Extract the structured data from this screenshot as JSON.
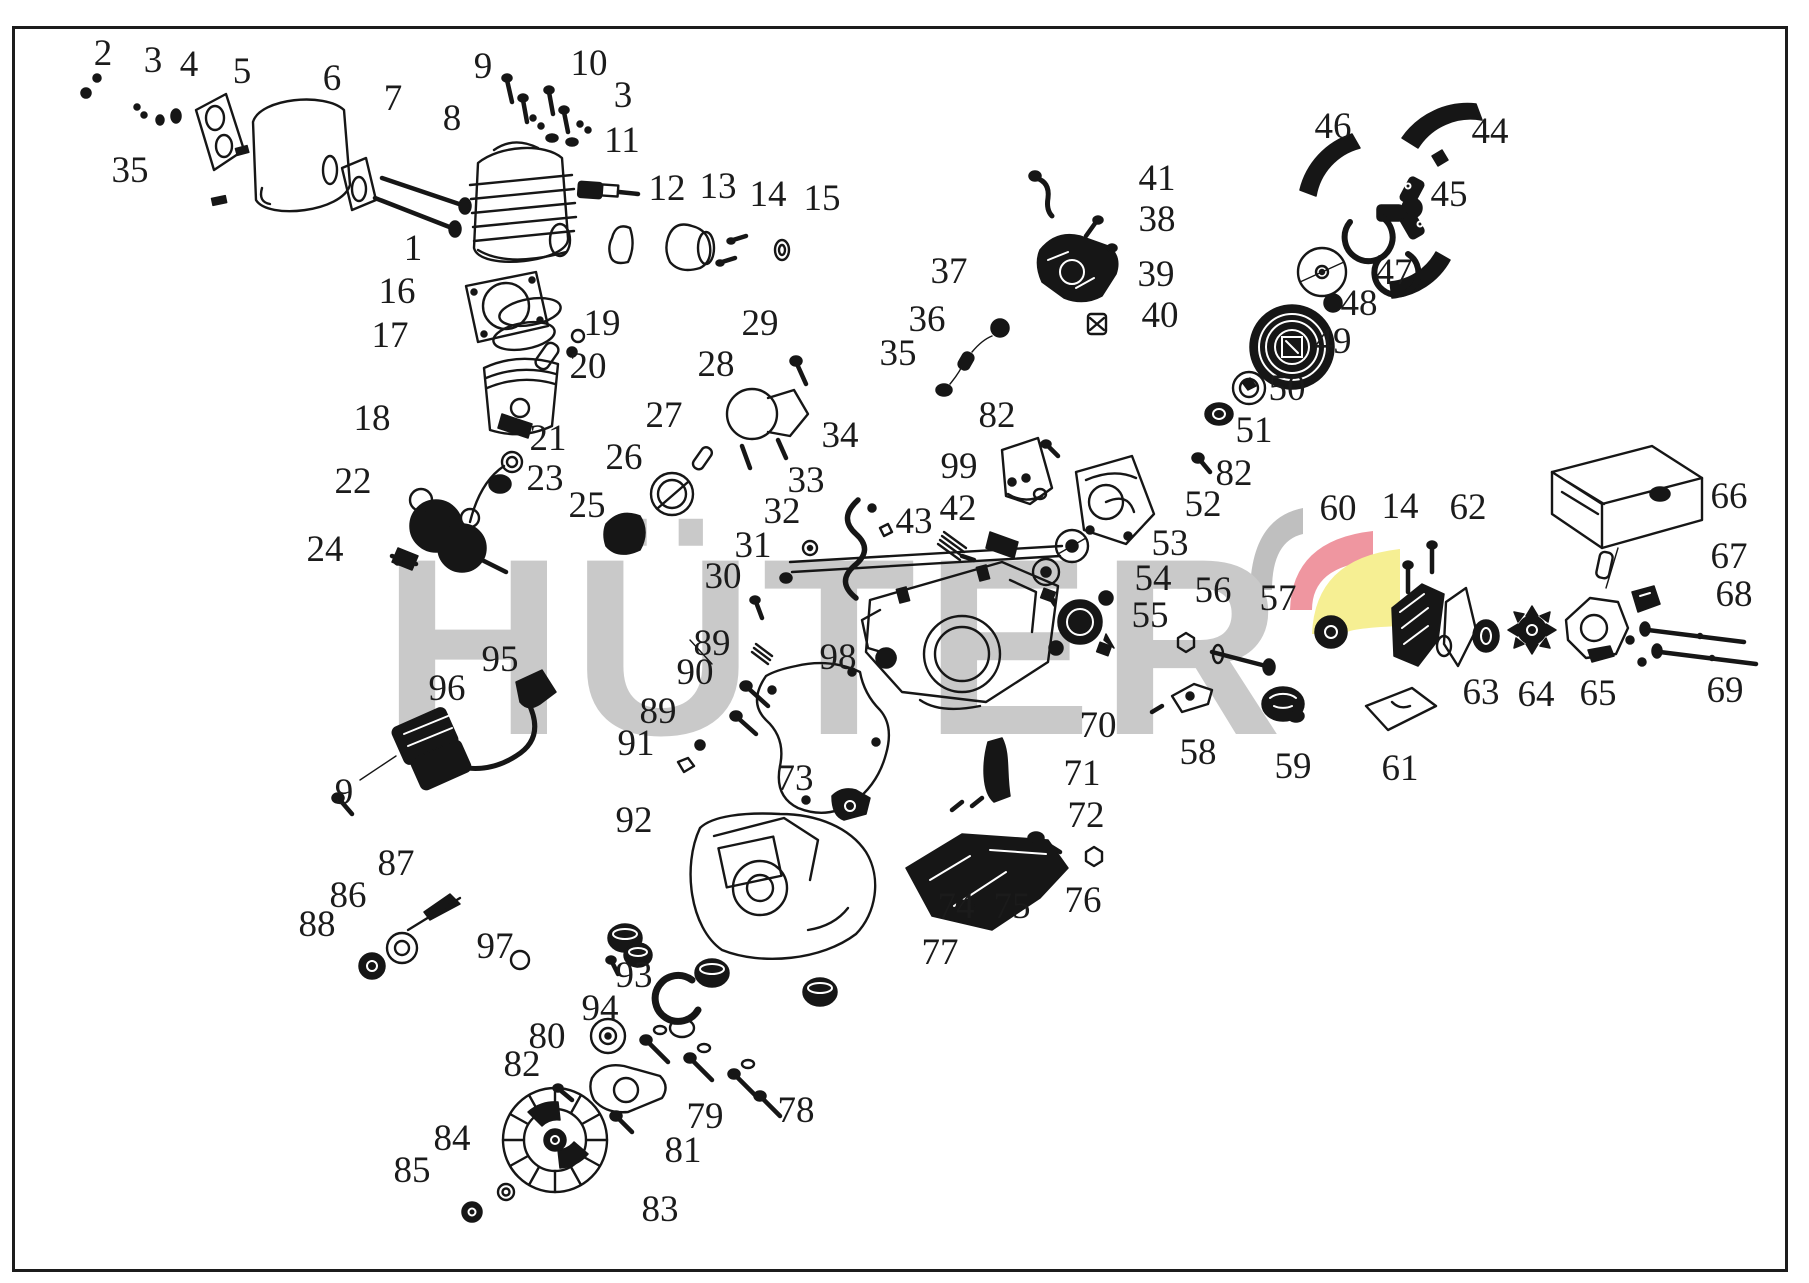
{
  "figure": {
    "width": 1809,
    "height": 1283,
    "border_color": "#1c1c1c",
    "background": "#ffffff"
  },
  "watermark": {
    "text": "HÜTER",
    "text_color": "#c9c9c9",
    "logo_colors": {
      "gray": "#bfbfbf",
      "red": "#ef96a0",
      "yellow": "#f6ef93"
    }
  },
  "diagram": {
    "type": "exploded-parts-diagram",
    "subject": "chainsaw engine and assembly",
    "label_color": "#1b1b1b",
    "line_color": "#1c1c1c"
  },
  "axis_lines": [
    [
      432,
      545,
      1425,
      693
    ],
    [
      408,
      558,
      1190,
      756
    ],
    [
      424,
      566,
      558,
      1120
    ]
  ],
  "labels": [
    {
      "id": "c1",
      "n": "1",
      "x": 413,
      "y": 250,
      "tx": 492,
      "ty": 272
    },
    {
      "id": "c2",
      "n": "2",
      "x": 103,
      "y": 55,
      "tx": 95,
      "ty": 88
    },
    {
      "id": "c3a",
      "n": "3",
      "x": 153,
      "y": 62,
      "tx": 142,
      "ty": 102
    },
    {
      "id": "c3b",
      "n": "3",
      "x": 623,
      "y": 97,
      "tx": 580,
      "ty": 122
    },
    {
      "id": "c4",
      "n": "4",
      "x": 189,
      "y": 66,
      "tx": 176,
      "ty": 112
    },
    {
      "id": "c5",
      "n": "5",
      "x": 242,
      "y": 73,
      "tx": 212,
      "ty": 125
    },
    {
      "id": "c6",
      "n": "6",
      "x": 332,
      "y": 80,
      "tx": 300,
      "ty": 108
    },
    {
      "id": "c7",
      "n": "7",
      "x": 393,
      "y": 100,
      "tx": 358,
      "ty": 162
    },
    {
      "id": "c8",
      "n": "8",
      "x": 452,
      "y": 120,
      "tx": 420,
      "ty": 180
    },
    {
      "id": "c9a",
      "n": "9",
      "x": 483,
      "y": 68,
      "tx": 512,
      "ty": 88
    },
    {
      "id": "c9b",
      "n": "9",
      "x": 344,
      "y": 794,
      "tx": 340,
      "ty": 806
    },
    {
      "id": "c10",
      "n": "10",
      "x": 589,
      "y": 65,
      "tx": 530,
      "ty": 110
    },
    {
      "id": "c11",
      "n": "11",
      "x": 622,
      "y": 142,
      "tx": 600,
      "ty": 182
    },
    {
      "id": "c12",
      "n": "12",
      "x": 667,
      "y": 190,
      "tx": 630,
      "ty": 232
    },
    {
      "id": "c13",
      "n": "13",
      "x": 718,
      "y": 188,
      "tx": 695,
      "ty": 225
    },
    {
      "id": "c14a",
      "n": "14",
      "x": 768,
      "y": 196,
      "tx": 740,
      "ty": 235
    },
    {
      "id": "c14b",
      "n": "14",
      "x": 1400,
      "y": 508,
      "tx": 1408,
      "ty": 566
    },
    {
      "id": "c15",
      "n": "15",
      "x": 822,
      "y": 200,
      "tx": 786,
      "ty": 242
    },
    {
      "id": "c16",
      "n": "16",
      "x": 397,
      "y": 293,
      "tx": 466,
      "ty": 300
    },
    {
      "id": "c17",
      "n": "17",
      "x": 390,
      "y": 337,
      "tx": 500,
      "ty": 318
    },
    {
      "id": "c18",
      "n": "18",
      "x": 372,
      "y": 420,
      "tx": 470,
      "ty": 428
    },
    {
      "id": "c19",
      "n": "19",
      "x": 602,
      "y": 325,
      "tx": 578,
      "ty": 336
    },
    {
      "id": "c20",
      "n": "20",
      "x": 588,
      "y": 368,
      "tx": 556,
      "ty": 360
    },
    {
      "id": "c21",
      "n": "21",
      "x": 548,
      "y": 440,
      "tx": 518,
      "ty": 460
    },
    {
      "id": "c22",
      "n": "22",
      "x": 353,
      "y": 483,
      "tx": 430,
      "ty": 505
    },
    {
      "id": "c23",
      "n": "23",
      "x": 545,
      "y": 480,
      "tx": 508,
      "ty": 482
    },
    {
      "id": "c24",
      "n": "24",
      "x": 325,
      "y": 551,
      "tx": 396,
      "ty": 559
    },
    {
      "id": "c25",
      "n": "25",
      "x": 587,
      "y": 507,
      "tx": 618,
      "ty": 532
    },
    {
      "id": "c26",
      "n": "26",
      "x": 624,
      "y": 459,
      "tx": 655,
      "ty": 488
    },
    {
      "id": "c27",
      "n": "27",
      "x": 664,
      "y": 417,
      "tx": 700,
      "ty": 450
    },
    {
      "id": "c28",
      "n": "28",
      "x": 716,
      "y": 366,
      "tx": 740,
      "ty": 400
    },
    {
      "id": "c29",
      "n": "29",
      "x": 760,
      "y": 325,
      "tx": 797,
      "ty": 362
    },
    {
      "id": "c30",
      "n": "30",
      "x": 723,
      "y": 578,
      "tx": 756,
      "ty": 600
    },
    {
      "id": "c31",
      "n": "31",
      "x": 753,
      "y": 547,
      "tx": 782,
      "ty": 575
    },
    {
      "id": "c32",
      "n": "32",
      "x": 782,
      "y": 513,
      "tx": 808,
      "ty": 545
    },
    {
      "id": "c33",
      "n": "33",
      "x": 806,
      "y": 482,
      "tx": 852,
      "ty": 520
    },
    {
      "id": "c34",
      "n": "34",
      "x": 840,
      "y": 437,
      "tx": 872,
      "ty": 505
    },
    {
      "id": "c35a",
      "n": "35",
      "x": 130,
      "y": 172,
      "tx": 212,
      "ty": 200
    },
    {
      "id": "c35b",
      "n": "35",
      "x": 898,
      "y": 355,
      "tx": 940,
      "ty": 388
    },
    {
      "id": "c36",
      "n": "36",
      "x": 927,
      "y": 321,
      "tx": 962,
      "ty": 358
    },
    {
      "id": "c37",
      "n": "37",
      "x": 949,
      "y": 273,
      "tx": 1000,
      "ty": 322
    },
    {
      "id": "c38",
      "n": "38",
      "x": 1157,
      "y": 221,
      "tx": 1086,
      "ty": 242
    },
    {
      "id": "c39",
      "n": "39",
      "x": 1156,
      "y": 276,
      "tx": 1092,
      "ty": 280
    },
    {
      "id": "c40",
      "n": "40",
      "x": 1160,
      "y": 317,
      "tx": 1100,
      "ty": 322
    },
    {
      "id": "c41",
      "n": "41",
      "x": 1157,
      "y": 180,
      "tx": 1048,
      "ty": 184
    },
    {
      "id": "c42",
      "n": "42",
      "x": 958,
      "y": 510,
      "tx": 1000,
      "ty": 537
    },
    {
      "id": "c43",
      "n": "43",
      "x": 914,
      "y": 523,
      "tx": 945,
      "ty": 550
    },
    {
      "id": "c44",
      "n": "44",
      "x": 1490,
      "y": 133,
      "tx": 1440,
      "ty": 133
    },
    {
      "id": "c45",
      "n": "45",
      "x": 1449,
      "y": 196,
      "tx": 1405,
      "ty": 203
    },
    {
      "id": "c46",
      "n": "46",
      "x": 1333,
      "y": 128,
      "tx": 1340,
      "ty": 212
    },
    {
      "id": "c47",
      "n": "47",
      "x": 1394,
      "y": 274,
      "tx": 1344,
      "ty": 273
    },
    {
      "id": "c48",
      "n": "48",
      "x": 1359,
      "y": 305,
      "tx": 1339,
      "ty": 303
    },
    {
      "id": "c49",
      "n": "49",
      "x": 1333,
      "y": 343,
      "tx": 1292,
      "ty": 347
    },
    {
      "id": "c50",
      "n": "50",
      "x": 1287,
      "y": 390,
      "tx": 1247,
      "ty": 387
    },
    {
      "id": "c51",
      "n": "51",
      "x": 1254,
      "y": 432,
      "tx": 1217,
      "ty": 415
    },
    {
      "id": "c52",
      "n": "52",
      "x": 1203,
      "y": 506,
      "tx": 1137,
      "ty": 505
    },
    {
      "id": "c53",
      "n": "53",
      "x": 1170,
      "y": 545,
      "tx": 1088,
      "ty": 546
    },
    {
      "id": "c54",
      "n": "54",
      "x": 1153,
      "y": 580,
      "tx": 1061,
      "ty": 571
    },
    {
      "id": "c55",
      "n": "55",
      "x": 1150,
      "y": 617,
      "tx": 1097,
      "ty": 622
    },
    {
      "id": "c56",
      "n": "56",
      "x": 1213,
      "y": 592,
      "tx": 1185,
      "ty": 642
    },
    {
      "id": "c57",
      "n": "57",
      "x": 1278,
      "y": 600,
      "tx": 1235,
      "ty": 655
    },
    {
      "id": "c58",
      "n": "58",
      "x": 1198,
      "y": 754,
      "tx": 1192,
      "ty": 705
    },
    {
      "id": "c59",
      "n": "59",
      "x": 1293,
      "y": 768,
      "tx": 1283,
      "ty": 718
    },
    {
      "id": "c60",
      "n": "60",
      "x": 1338,
      "y": 510,
      "tx": 1331,
      "ty": 616
    },
    {
      "id": "c61",
      "n": "61",
      "x": 1400,
      "y": 770,
      "tx": 1398,
      "ty": 732
    },
    {
      "id": "c62",
      "n": "62",
      "x": 1468,
      "y": 509,
      "tx": 1456,
      "ty": 597
    },
    {
      "id": "c63",
      "n": "63",
      "x": 1481,
      "y": 694,
      "tx": 1485,
      "ty": 652
    },
    {
      "id": "c64",
      "n": "64",
      "x": 1536,
      "y": 696,
      "tx": 1533,
      "ty": 650
    },
    {
      "id": "c65",
      "n": "65",
      "x": 1598,
      "y": 695,
      "tx": 1596,
      "ty": 657
    },
    {
      "id": "c66",
      "n": "66",
      "x": 1729,
      "y": 498,
      "tx": 1700,
      "ty": 496
    },
    {
      "id": "c67",
      "n": "67",
      "x": 1729,
      "y": 558,
      "tx": 1620,
      "ty": 572
    },
    {
      "id": "c68",
      "n": "68",
      "x": 1734,
      "y": 596,
      "tx": 1660,
      "ty": 602
    },
    {
      "id": "c69",
      "n": "69",
      "x": 1725,
      "y": 692,
      "tx": 1700,
      "ty": 660
    },
    {
      "id": "c70",
      "n": "70",
      "x": 1098,
      "y": 727,
      "tx": 1000,
      "ty": 682
    },
    {
      "id": "c71",
      "n": "71",
      "x": 1082,
      "y": 775,
      "tx": 1012,
      "ty": 778
    },
    {
      "id": "c72",
      "n": "72",
      "x": 1086,
      "y": 817,
      "tx": 1000,
      "ty": 808
    },
    {
      "id": "c73",
      "n": "73",
      "x": 795,
      "y": 780,
      "tx": 846,
      "ty": 803
    },
    {
      "id": "c74",
      "n": "74",
      "x": 956,
      "y": 908,
      "tx": 1000,
      "ty": 870
    },
    {
      "id": "c75",
      "n": "75",
      "x": 1012,
      "y": 908,
      "tx": 1038,
      "ty": 845
    },
    {
      "id": "c76",
      "n": "76",
      "x": 1083,
      "y": 902,
      "tx": 1093,
      "ty": 860
    },
    {
      "id": "c77",
      "n": "77",
      "x": 940,
      "y": 954,
      "tx": 968,
      "ty": 916
    },
    {
      "id": "c78",
      "n": "78",
      "x": 796,
      "y": 1112,
      "tx": 764,
      "ty": 1096
    },
    {
      "id": "c79",
      "n": "79",
      "x": 705,
      "y": 1118,
      "tx": 654,
      "ty": 1062
    },
    {
      "id": "c80",
      "n": "80",
      "x": 547,
      "y": 1038,
      "tx": 600,
      "ty": 1080
    },
    {
      "id": "c81",
      "n": "81",
      "x": 683,
      "y": 1152,
      "tx": 620,
      "ty": 1122
    },
    {
      "id": "c82a",
      "n": "82",
      "x": 997,
      "y": 417,
      "tx": 1048,
      "ty": 450
    },
    {
      "id": "c82b",
      "n": "82",
      "x": 1234,
      "y": 475,
      "tx": 1204,
      "ty": 463
    },
    {
      "id": "c82c",
      "n": "82",
      "x": 522,
      "y": 1066,
      "tx": 558,
      "ty": 1092
    },
    {
      "id": "c83",
      "n": "83",
      "x": 660,
      "y": 1211,
      "tx": 600,
      "ty": 1166
    },
    {
      "id": "c84",
      "n": "84",
      "x": 452,
      "y": 1140,
      "tx": 504,
      "ty": 1190
    },
    {
      "id": "c85",
      "n": "85",
      "x": 412,
      "y": 1172,
      "tx": 468,
      "ty": 1210
    },
    {
      "id": "c86",
      "n": "86",
      "x": 348,
      "y": 897,
      "tx": 398,
      "ty": 943
    },
    {
      "id": "c87",
      "n": "87",
      "x": 396,
      "y": 865,
      "tx": 436,
      "ty": 903
    },
    {
      "id": "c88",
      "n": "88",
      "x": 317,
      "y": 926,
      "tx": 368,
      "ty": 962
    },
    {
      "id": "c89a",
      "n": "89",
      "x": 712,
      "y": 645,
      "tx": 757,
      "ty": 692
    },
    {
      "id": "c89b",
      "n": "89",
      "x": 658,
      "y": 713,
      "tx": 705,
      "ty": 743
    },
    {
      "id": "c90",
      "n": "90",
      "x": 695,
      "y": 674,
      "tx": 747,
      "ty": 722
    },
    {
      "id": "c91",
      "n": "91",
      "x": 636,
      "y": 745,
      "tx": 682,
      "ty": 765
    },
    {
      "id": "c92",
      "n": "92",
      "x": 634,
      "y": 822,
      "tx": 692,
      "ty": 900
    },
    {
      "id": "c93",
      "n": "93",
      "x": 634,
      "y": 977,
      "tx": 668,
      "ty": 995
    },
    {
      "id": "c94",
      "n": "94",
      "x": 600,
      "y": 1010,
      "tx": 606,
      "ty": 1034
    },
    {
      "id": "c95",
      "n": "95",
      "x": 500,
      "y": 661,
      "tx": 528,
      "ty": 686
    },
    {
      "id": "c96",
      "n": "96",
      "x": 447,
      "y": 690,
      "tx": 432,
      "ty": 735
    },
    {
      "id": "c97",
      "n": "97",
      "x": 495,
      "y": 948,
      "tx": 516,
      "ty": 958
    },
    {
      "id": "c98",
      "n": "98",
      "x": 838,
      "y": 659,
      "tx": 818,
      "ty": 700
    },
    {
      "id": "c99",
      "n": "99",
      "x": 959,
      "y": 468,
      "tx": 1002,
      "ty": 480
    }
  ]
}
